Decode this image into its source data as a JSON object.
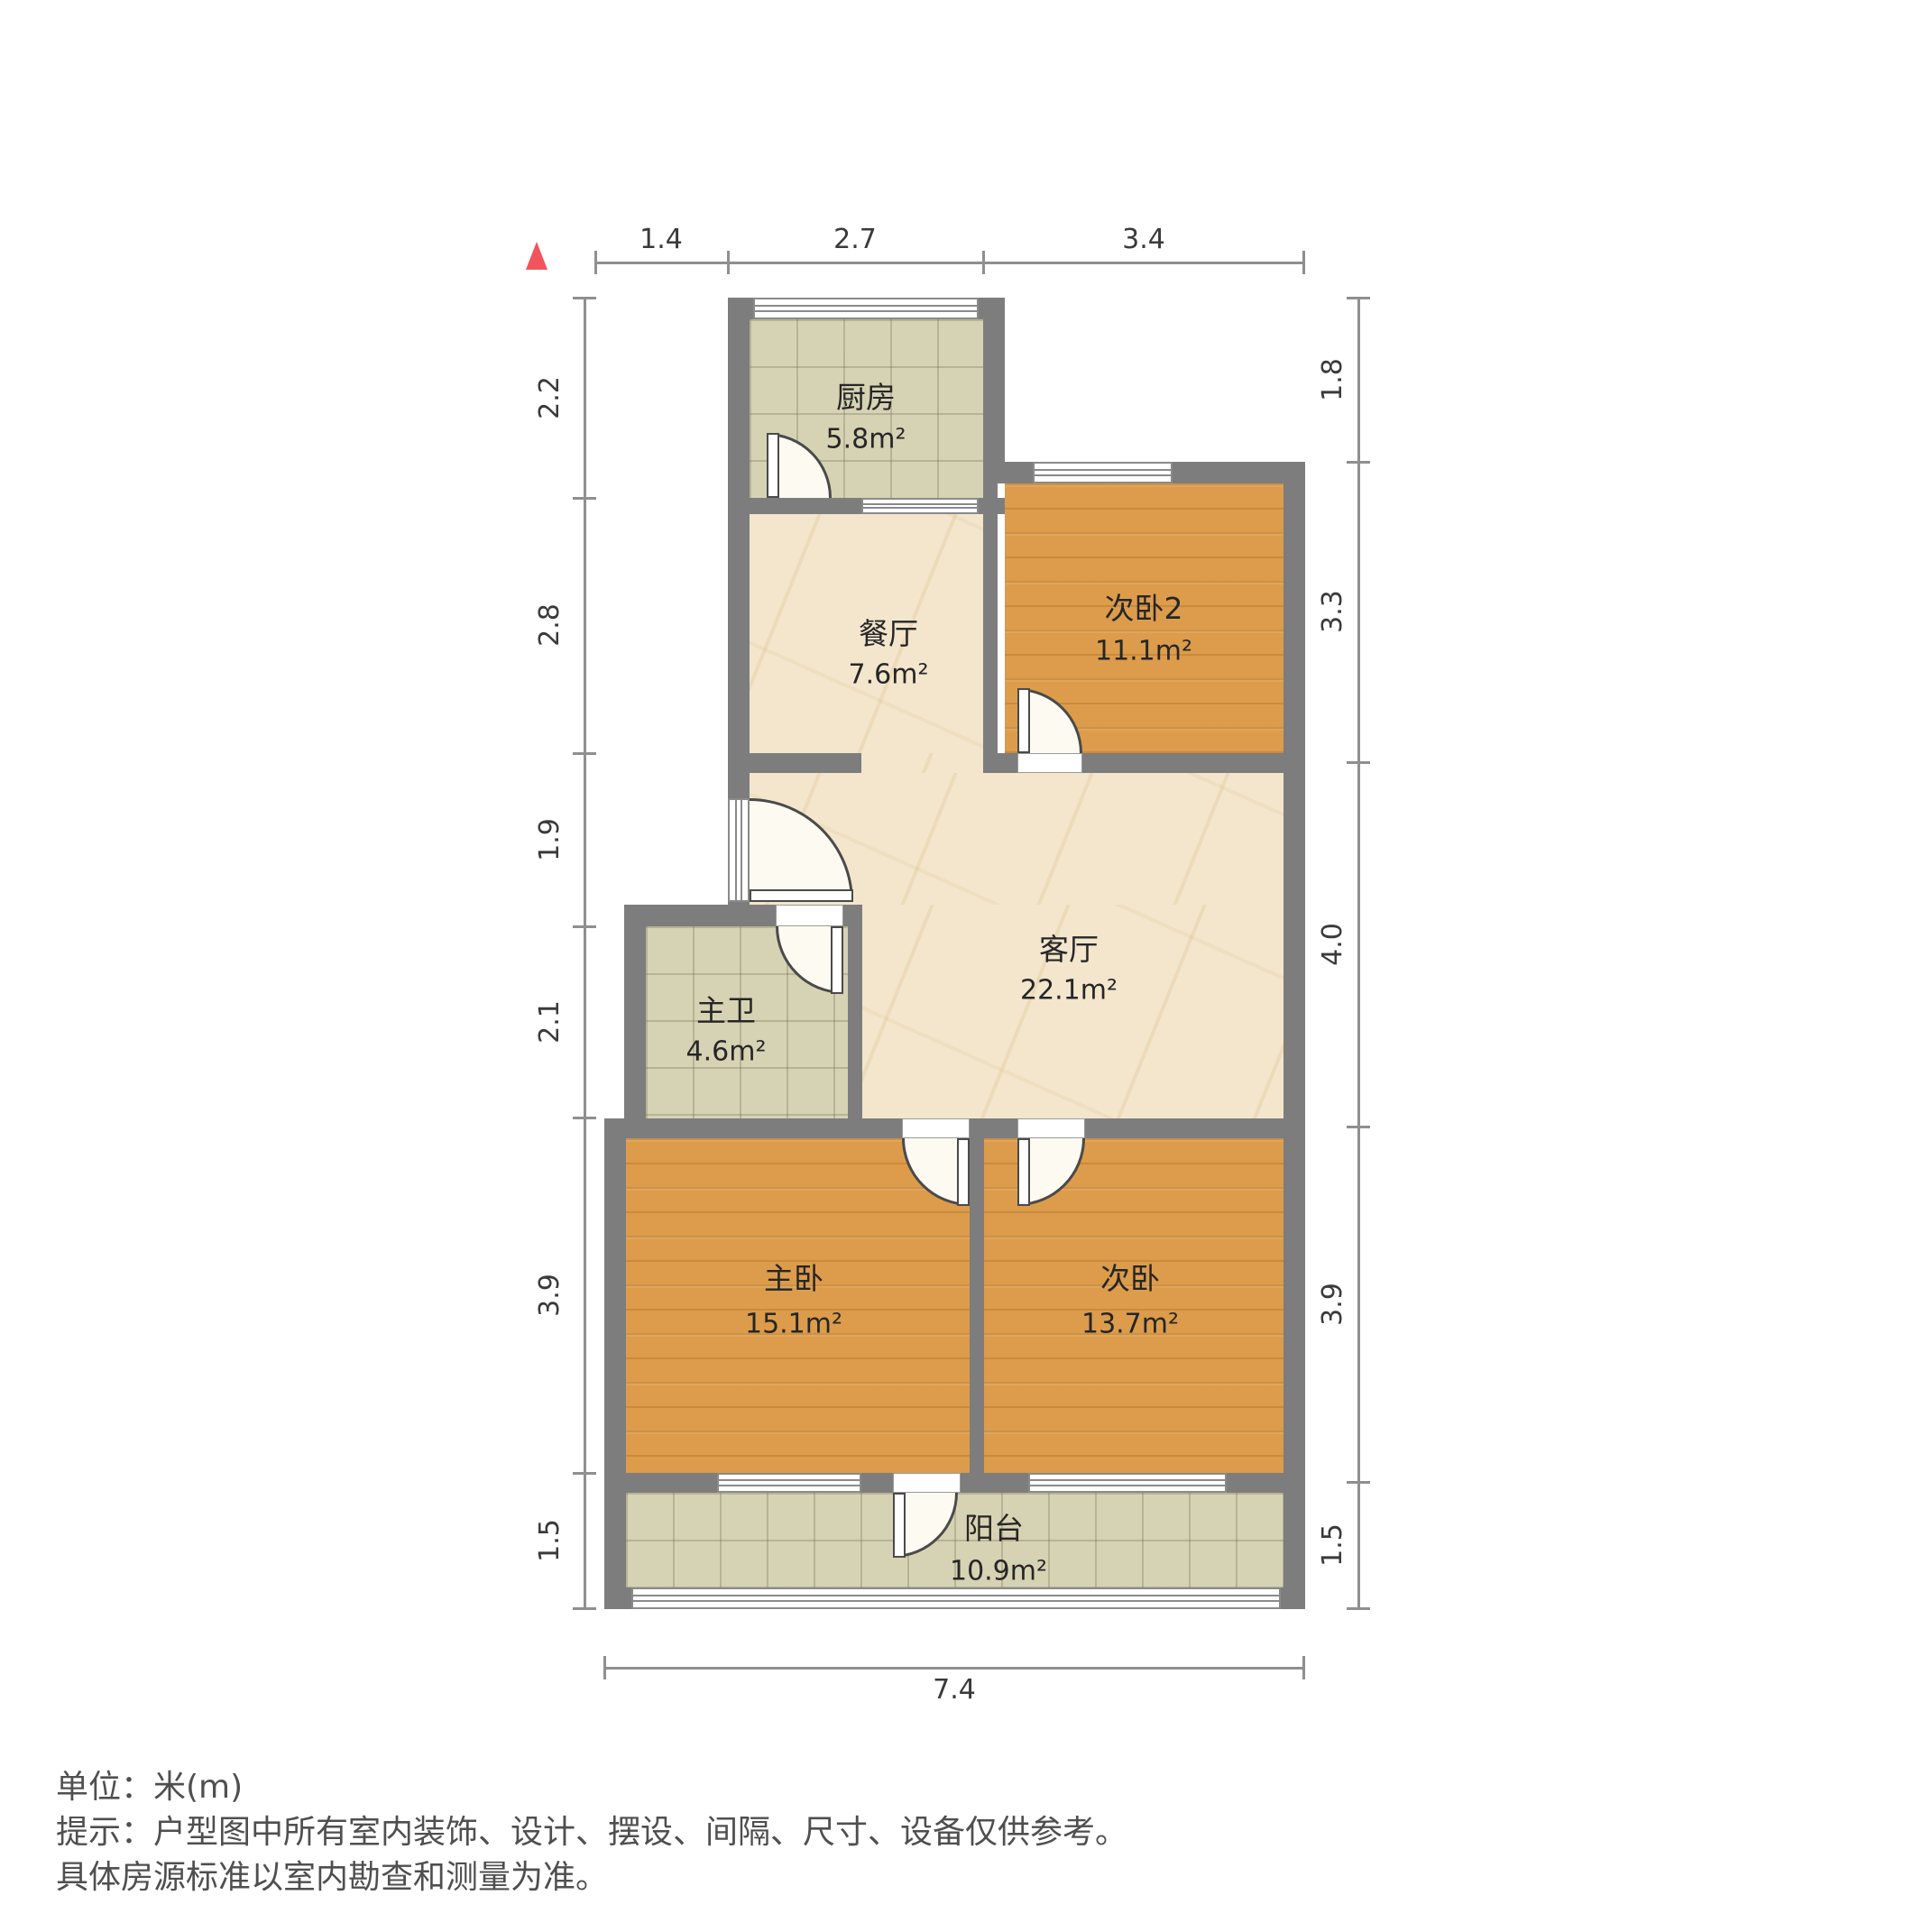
{
  "rooms": [
    {
      "key": "kitchen",
      "name": "厨房",
      "area": "5.8m²"
    },
    {
      "key": "dining",
      "name": "餐厅",
      "area": "7.6m²"
    },
    {
      "key": "bedroom2",
      "name": "次卧2",
      "area": "11.1m²"
    },
    {
      "key": "living",
      "name": "客厅",
      "area": "22.1m²"
    },
    {
      "key": "master-bath",
      "name": "主卫",
      "area": "4.6m²"
    },
    {
      "key": "master-bedroom",
      "name": "主卧",
      "area": "15.1m²"
    },
    {
      "key": "second-bedroom",
      "name": "次卧",
      "area": "13.7m²"
    },
    {
      "key": "balcony",
      "name": "阳台",
      "area": "10.9m²"
    }
  ],
  "dims": {
    "top": [
      "1.4",
      "2.7",
      "3.4"
    ],
    "left": [
      "2.2",
      "2.8",
      "1.9",
      "2.1",
      "3.9",
      "1.5"
    ],
    "right": [
      "1.8",
      "3.3",
      "4.0",
      "3.9",
      "1.5"
    ],
    "bottom": [
      "7.4"
    ]
  },
  "footer": {
    "unit": "单位：米(m)",
    "tip": "提示：户型图中所有室内装饰、设计、摆设、间隔、尺寸、设备仅供参考。",
    "tip2": "具体房源标准以室内勘查和测量为准。"
  },
  "icons": {
    "north": "north-triangle"
  },
  "colors": {
    "wall": "#7d7d7d",
    "wood": "#dc9c4b",
    "tile": "#d6d3b4",
    "marble": "#f3e6cd",
    "north": "#f2545b",
    "dim_text": "#3a3a3a",
    "footer_text": "#4f4f4f"
  }
}
